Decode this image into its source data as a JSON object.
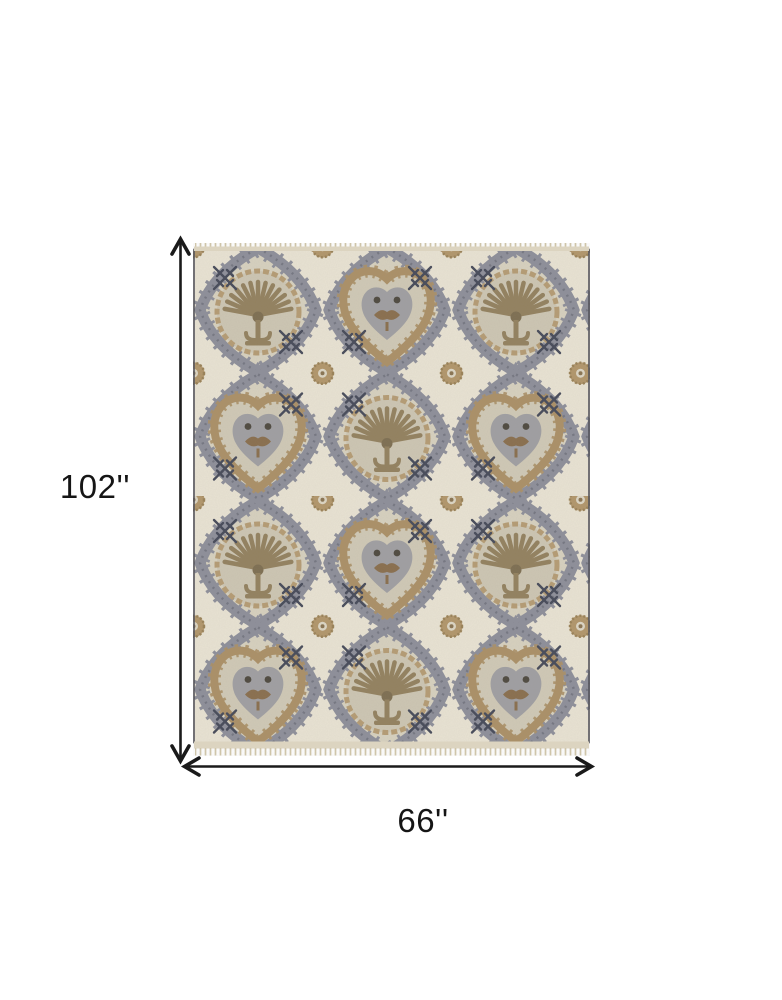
{
  "dimension_diagram": {
    "height": {
      "value": "102''"
    },
    "width": {
      "value": "66''"
    },
    "arrow_color": "#1a1a1a",
    "label_color": "#151515"
  },
  "rug": {
    "pattern": "ikat-medallion",
    "colors": {
      "field_ivory": "#e9e3d3",
      "inner_cream": "#d7d1bf",
      "lattice_gray": "#8e8f9a",
      "tan": "#ac9168",
      "fan_brown": "#93815f",
      "dark_navy": "#474b5a",
      "fringe": "#dcd4c0",
      "border_line": "#55555d"
    }
  }
}
